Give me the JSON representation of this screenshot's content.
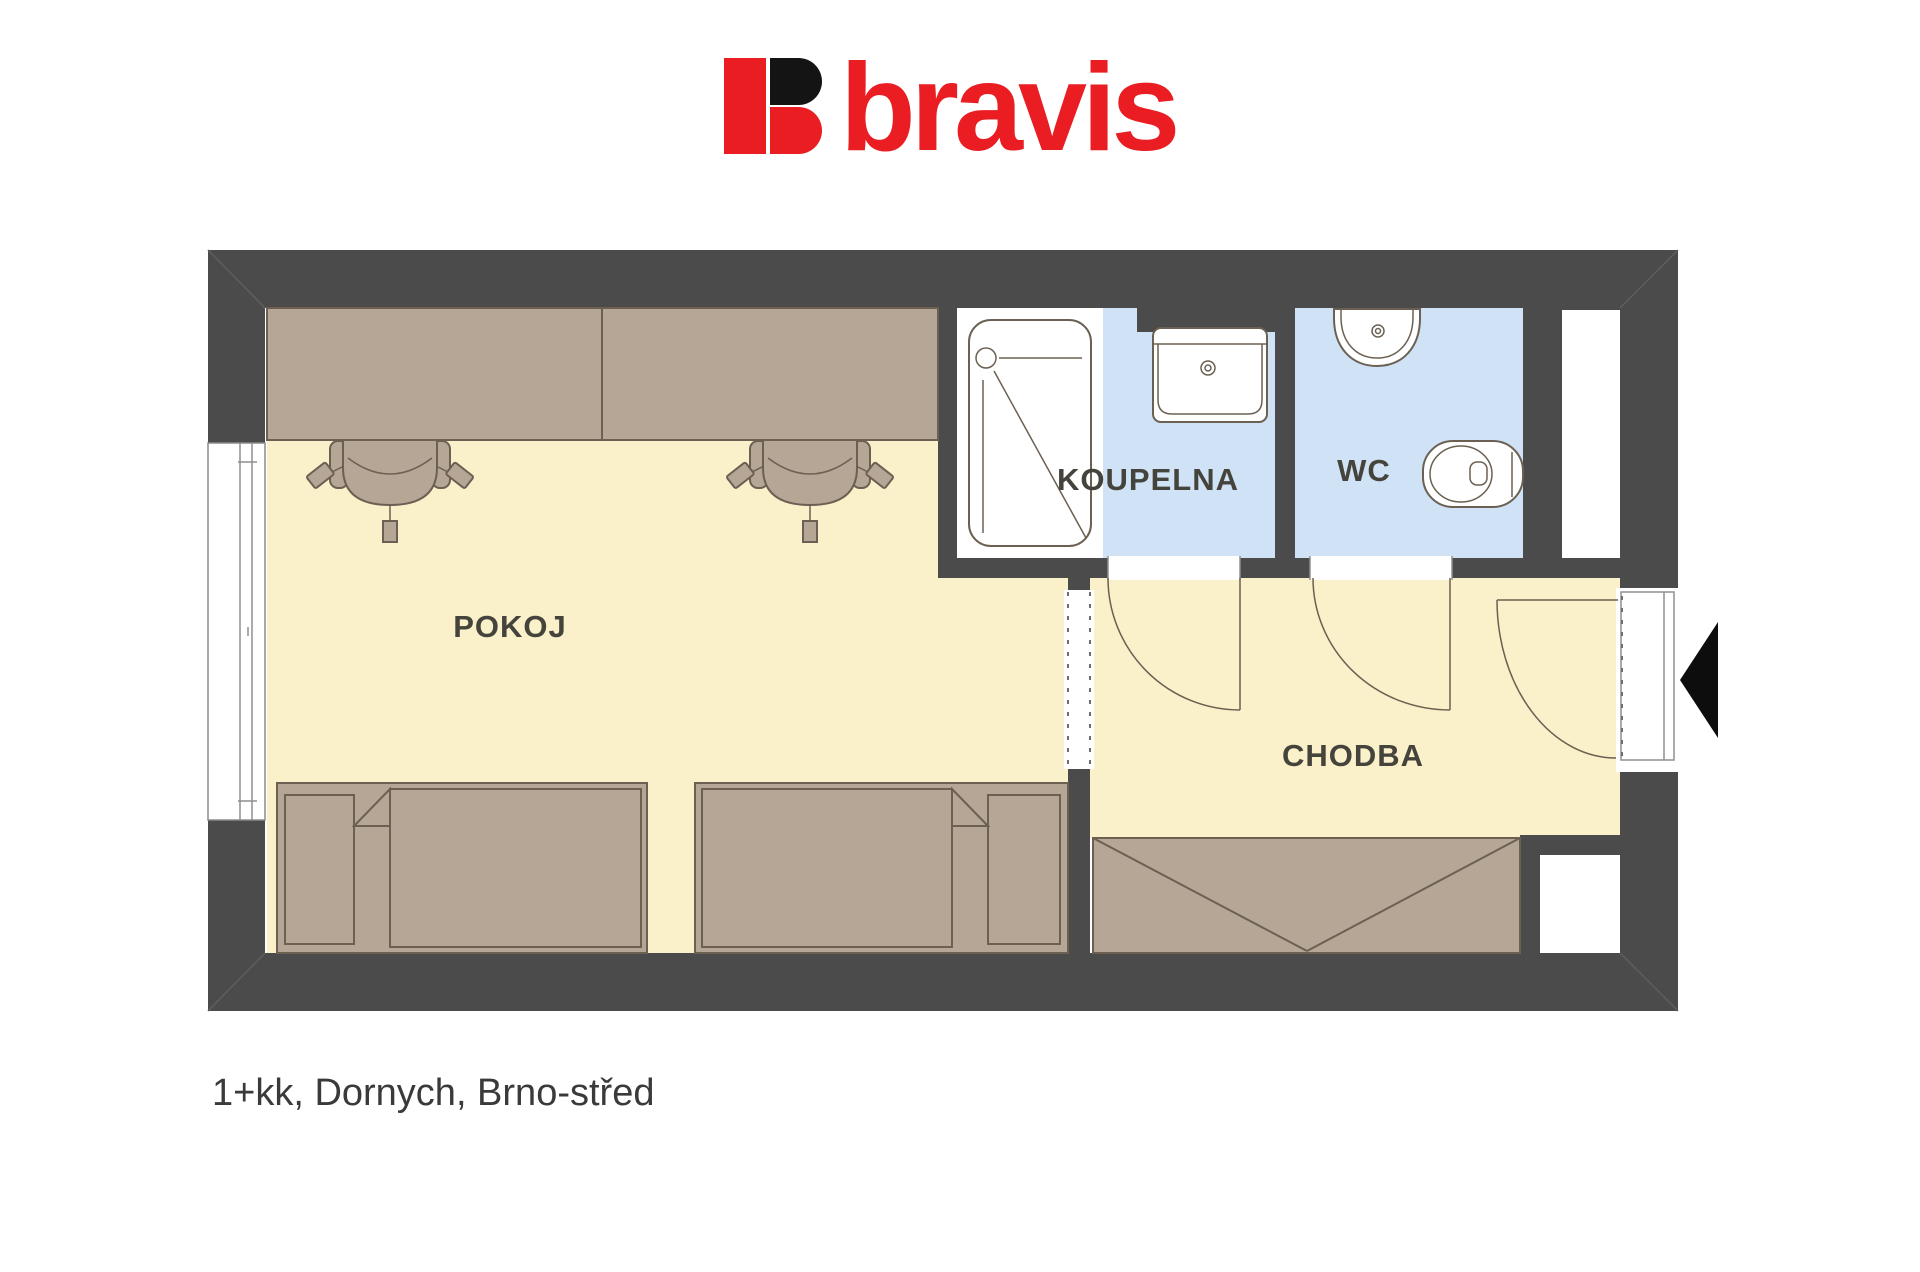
{
  "logo": {
    "brand": "bravis"
  },
  "caption": {
    "text": "1+kk, Dornych, Brno-střed"
  },
  "plan": {
    "rooms": [
      {
        "id": "pokoj",
        "label": "POKOJ"
      },
      {
        "id": "koupelna",
        "label": "KOUPELNA"
      },
      {
        "id": "wc",
        "label": "WC"
      },
      {
        "id": "chodba",
        "label": "CHODBA"
      }
    ],
    "furniture": [
      "desk",
      "office-chair",
      "bed",
      "wardrobe",
      "shower",
      "sink",
      "washbasin",
      "toilet",
      "entrance-door"
    ]
  },
  "colors": {
    "wall": "#4b4b4b",
    "room_floor": "#faf0c9",
    "bath_floor": "#cfe2f6",
    "furniture": "#b5a696",
    "outline": "#6b6052",
    "label": "#45443c",
    "logo_red": "#e91d22",
    "logo_black": "#141414",
    "caption": "#3a3a3a"
  }
}
